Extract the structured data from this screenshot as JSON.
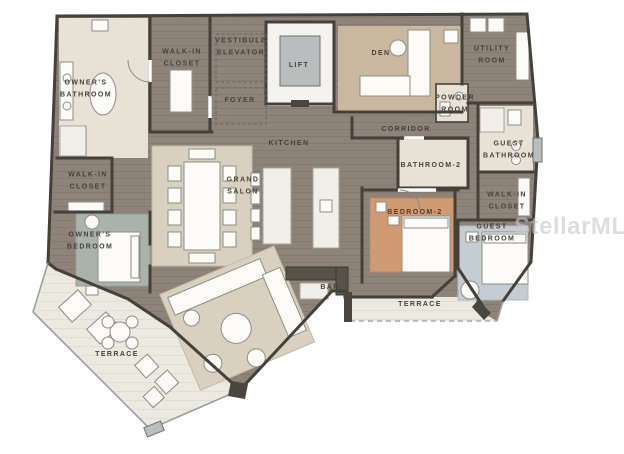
{
  "watermark": "StellarMLS",
  "rooms": [
    {
      "name": "owners-bathroom",
      "label": "OWNER'S\nBATHROOM"
    },
    {
      "name": "walk-in-closet-north",
      "label": "WALK-IN\nCLOSET"
    },
    {
      "name": "vestibule-elevator",
      "label": "VESTIBULE\nELEVATOR"
    },
    {
      "name": "lift",
      "label": "LIFT"
    },
    {
      "name": "foyer",
      "label": "FOYER"
    },
    {
      "name": "den",
      "label": "DEN"
    },
    {
      "name": "utility-room",
      "label": "UTILITY\nROOM"
    },
    {
      "name": "powder-room",
      "label": "POWDER\nROOM"
    },
    {
      "name": "corridor",
      "label": "CORRIDOR"
    },
    {
      "name": "kitchen",
      "label": "KITCHEN"
    },
    {
      "name": "bathroom-2",
      "label": "BATHROOM-2"
    },
    {
      "name": "guest-bathroom",
      "label": "GUEST\nBATHROOM"
    },
    {
      "name": "grand-salon",
      "label": "GRAND\nSALON"
    },
    {
      "name": "walk-in-closet-west",
      "label": "WALK-IN\nCLOSET"
    },
    {
      "name": "walk-in-closet-east",
      "label": "WALK-IN\nCLOSET"
    },
    {
      "name": "bedroom-2",
      "label": "BEDROOM-2"
    },
    {
      "name": "owners-bedroom",
      "label": "OWNER'S\nBEDROOM"
    },
    {
      "name": "guest-bedroom",
      "label": "GUEST\nBEDROOM"
    },
    {
      "name": "bar",
      "label": "BAR"
    },
    {
      "name": "terrace-west",
      "label": "TERRACE"
    },
    {
      "name": "terrace-east",
      "label": "TERRACE"
    }
  ],
  "colors": {
    "wall": "#45403a",
    "floor_wood": "#8e8379",
    "floor_wood_line": "#83796f",
    "terrace": "#ebe9e0",
    "den_carpet": "#c9b89f",
    "bath_floor": "#e8e1d5",
    "rug_salon": "#d9d0c0",
    "rug_bedroom2": "#d09a74",
    "rug_owner": "#a9b2ab",
    "rug_guest": "#c4cdd3",
    "watermark": "#c9c9c9"
  }
}
